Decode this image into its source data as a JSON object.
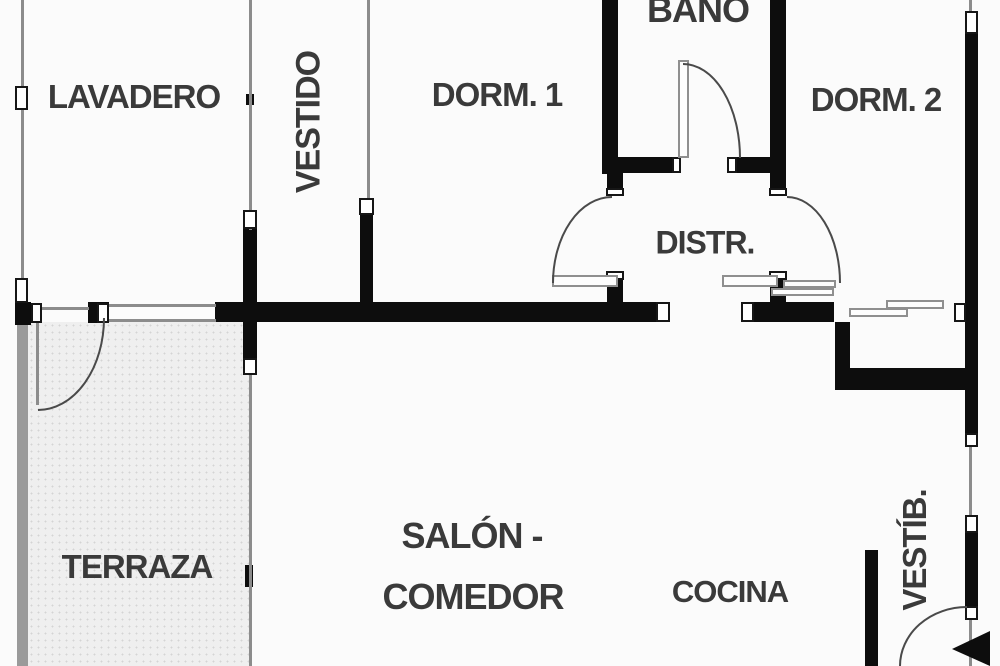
{
  "plan": {
    "type": "apartment floor plan",
    "rooms": {
      "lavadero": "LAVADERO",
      "vestidor": "VESTIDO",
      "dorm1": "DORM. 1",
      "bano": "BAÑO",
      "dorm2": "DORM. 2",
      "distribuidor": "DISTR.",
      "terraza": "TERRAZA",
      "salon_line1": "SALÓN -",
      "salon_line2": "COMEDOR",
      "cocina": "COCINA",
      "vestibulo": "VESTÍB."
    },
    "colors": {
      "wall": "#0d0d0d",
      "label_text": "#3a3a3a",
      "thin_line": "#8c8c8c",
      "terraza_fill": "#efefef"
    }
  }
}
